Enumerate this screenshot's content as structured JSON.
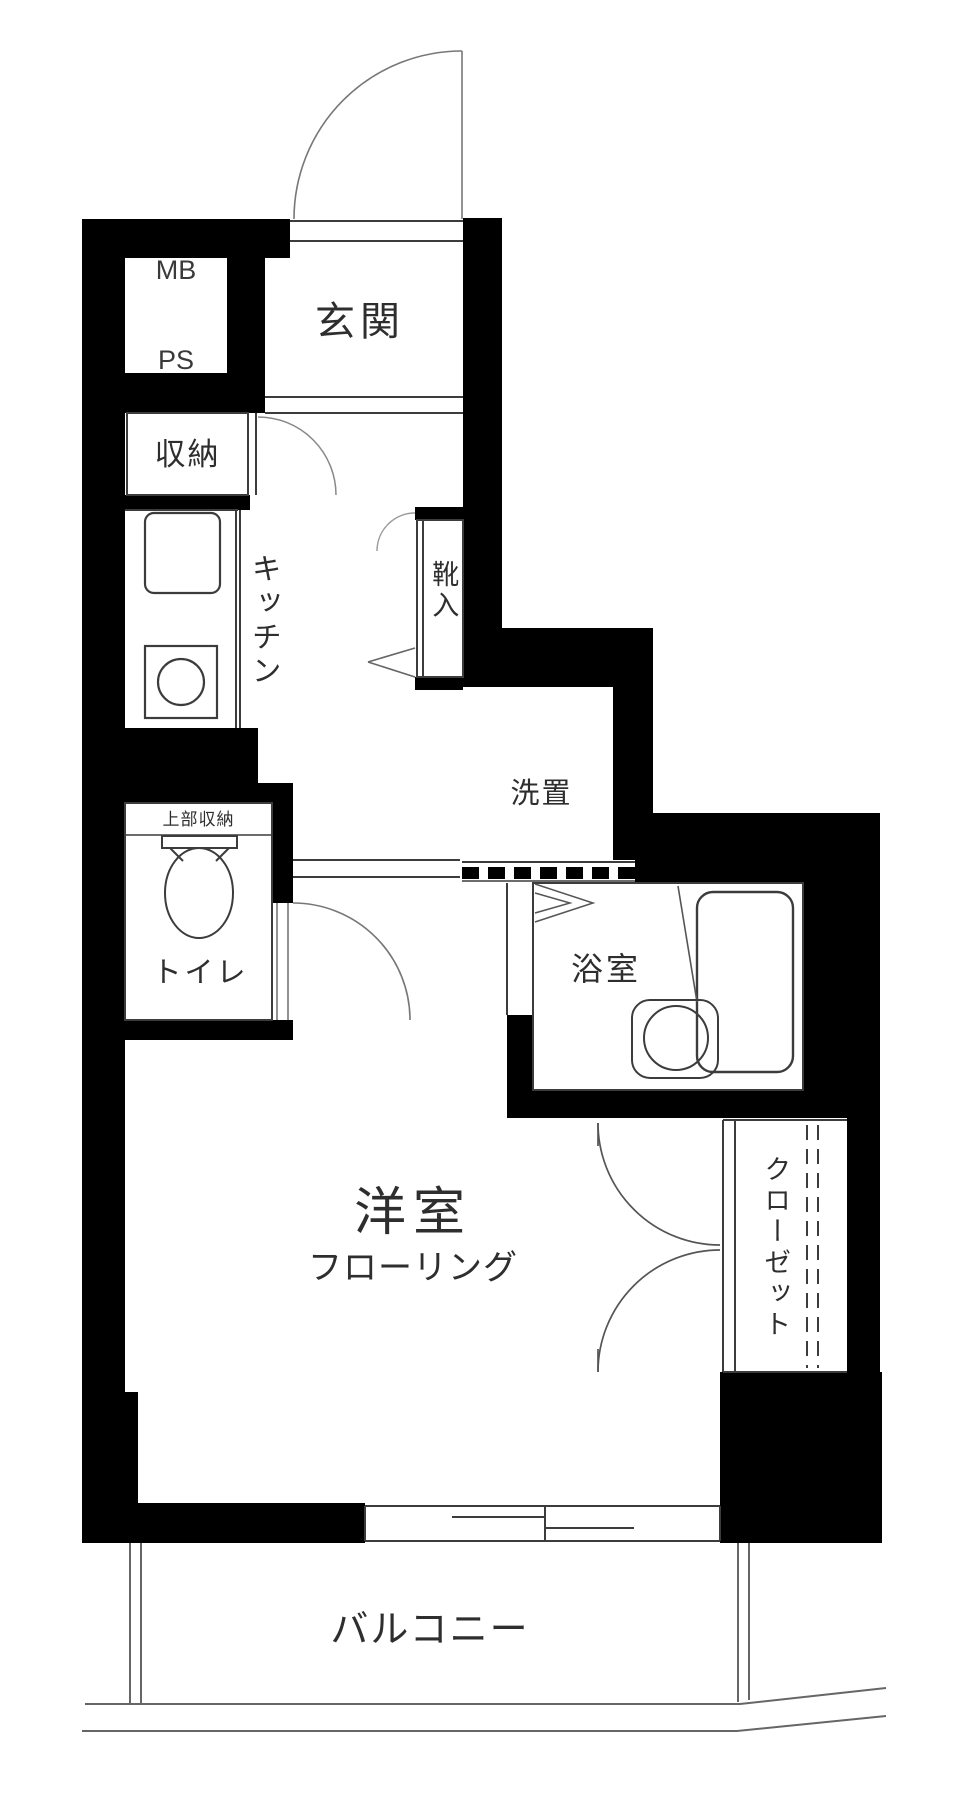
{
  "rooms": {
    "meter_pipe_space": {
      "line1": "MB",
      "line2": "PS"
    },
    "entrance": {
      "label": "玄関"
    },
    "storage": {
      "label": "収納"
    },
    "kitchen": {
      "label": "キッチン"
    },
    "shoe_cabinet": {
      "label": "靴入"
    },
    "washer_space": {
      "label": "洗置"
    },
    "toilet": {
      "label": "トイレ",
      "upper_storage": "上部収納"
    },
    "bathroom": {
      "label": "浴室"
    },
    "western_room": {
      "label": "洋室",
      "sublabel": "フローリング"
    },
    "closet": {
      "label": "クローゼット"
    },
    "balcony": {
      "label": "バルコニー"
    }
  },
  "colors": {
    "wall": "#000000",
    "thin_line": "#444444",
    "door_arc": "#888888",
    "background": "#ffffff",
    "text": "#2e2e2e"
  }
}
